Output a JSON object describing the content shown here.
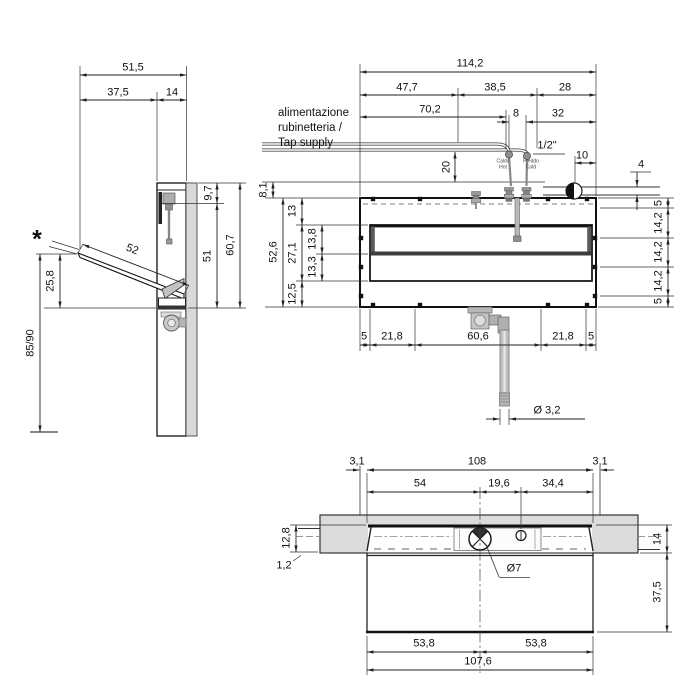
{
  "drawing": {
    "note_marker": "*",
    "supply_note": {
      "line1": "alimentazione",
      "line2": "rubinetteria /",
      "line3": "Tap supply"
    },
    "hot": {
      "it": "Caldo",
      "en": "Hot"
    },
    "cold": {
      "it": "Freddo",
      "en": "Cold"
    },
    "side": {
      "width_total": "51,5",
      "width_flap": "37,5",
      "depth": "14",
      "flap_length": "52",
      "flap_drop": "25,8",
      "mount_height": "85/90",
      "top_inset": "9,7",
      "front_height": "51",
      "height_total": "60,7"
    },
    "front": {
      "width_total": "114,2",
      "w_left": "47,7",
      "w_mid": "38,5",
      "w_right": "28",
      "supply_offset": "70,2",
      "tap_spacing": "8",
      "d_right": "32",
      "tap_thread": "1/2\"",
      "supply_rise": "20",
      "drain_offset": "10",
      "drain_pipe": "4",
      "top_gap": "8,1",
      "height_total": "52,6",
      "h_top": "13",
      "h_basin": "27,1",
      "h_basin_upper": "13,8",
      "h_basin_lower": "13,3",
      "h_bottom": "12,5",
      "fix_r1": "5",
      "fix_r2": "14,2",
      "fix_r3": "14,2",
      "fix_r4": "14,2",
      "fix_r5": "5",
      "fix_b1": "5",
      "fix_b2": "21,8",
      "fix_b3": "60,6",
      "fix_b4": "21,8",
      "fix_b5": "5",
      "waste_pipe_dia": "Ø 3,2"
    },
    "plan": {
      "gap_left": "3,1",
      "width_inner": "108",
      "gap_right": "3,1",
      "p_left": "54",
      "p_mid": "19,6",
      "p_right": "34,4",
      "lip_depth": "12,8",
      "lip_edge": "1,2",
      "wall_depth": "14",
      "bowl_depth": "37,5",
      "hole_dia": "Ø7",
      "half_left": "53,8",
      "half_right": "53,8",
      "width_outer": "107,6"
    }
  }
}
